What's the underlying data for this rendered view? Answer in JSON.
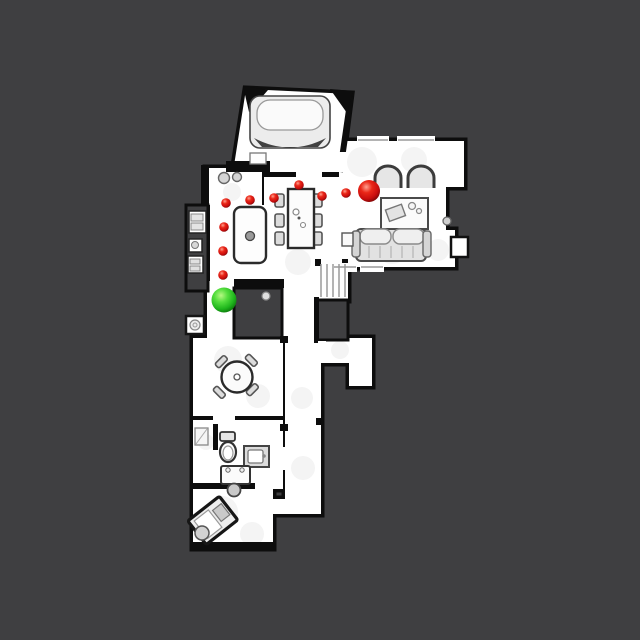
{
  "scene": {
    "view": "top-down indoor floor plan with navigation markers",
    "background_color": "#3f3f41",
    "floor_color": "#ffffff",
    "wall_color": "#0d0d0d"
  },
  "markers": {
    "start": {
      "name": "start-marker",
      "x": 224,
      "y": 300,
      "r": 12.5,
      "color": "#1eb51c"
    },
    "goal": {
      "name": "goal-marker",
      "x": 369,
      "y": 191,
      "r": 11,
      "color": "#cf1010"
    },
    "waypoint_color": "#cf1010",
    "waypoint_count": 9,
    "waypoints": [
      {
        "x": 226,
        "y": 203,
        "r": 4.8
      },
      {
        "x": 250,
        "y": 200,
        "r": 4.8
      },
      {
        "x": 274,
        "y": 198,
        "r": 4.8
      },
      {
        "x": 299,
        "y": 185,
        "r": 4.8
      },
      {
        "x": 322,
        "y": 196,
        "r": 4.8
      },
      {
        "x": 346,
        "y": 193,
        "r": 4.8
      },
      {
        "x": 224,
        "y": 227,
        "r": 4.8
      },
      {
        "x": 223,
        "y": 251,
        "r": 4.8
      },
      {
        "x": 223,
        "y": 275,
        "r": 4.8
      }
    ],
    "sphere_gradients": {
      "red": [
        "#ffa08f",
        "#ea2718",
        "#c90d0d",
        "#6e0404"
      ],
      "green": [
        "#b6f883",
        "#55de3e",
        "#1eb51c",
        "#0b6e09"
      ]
    }
  }
}
